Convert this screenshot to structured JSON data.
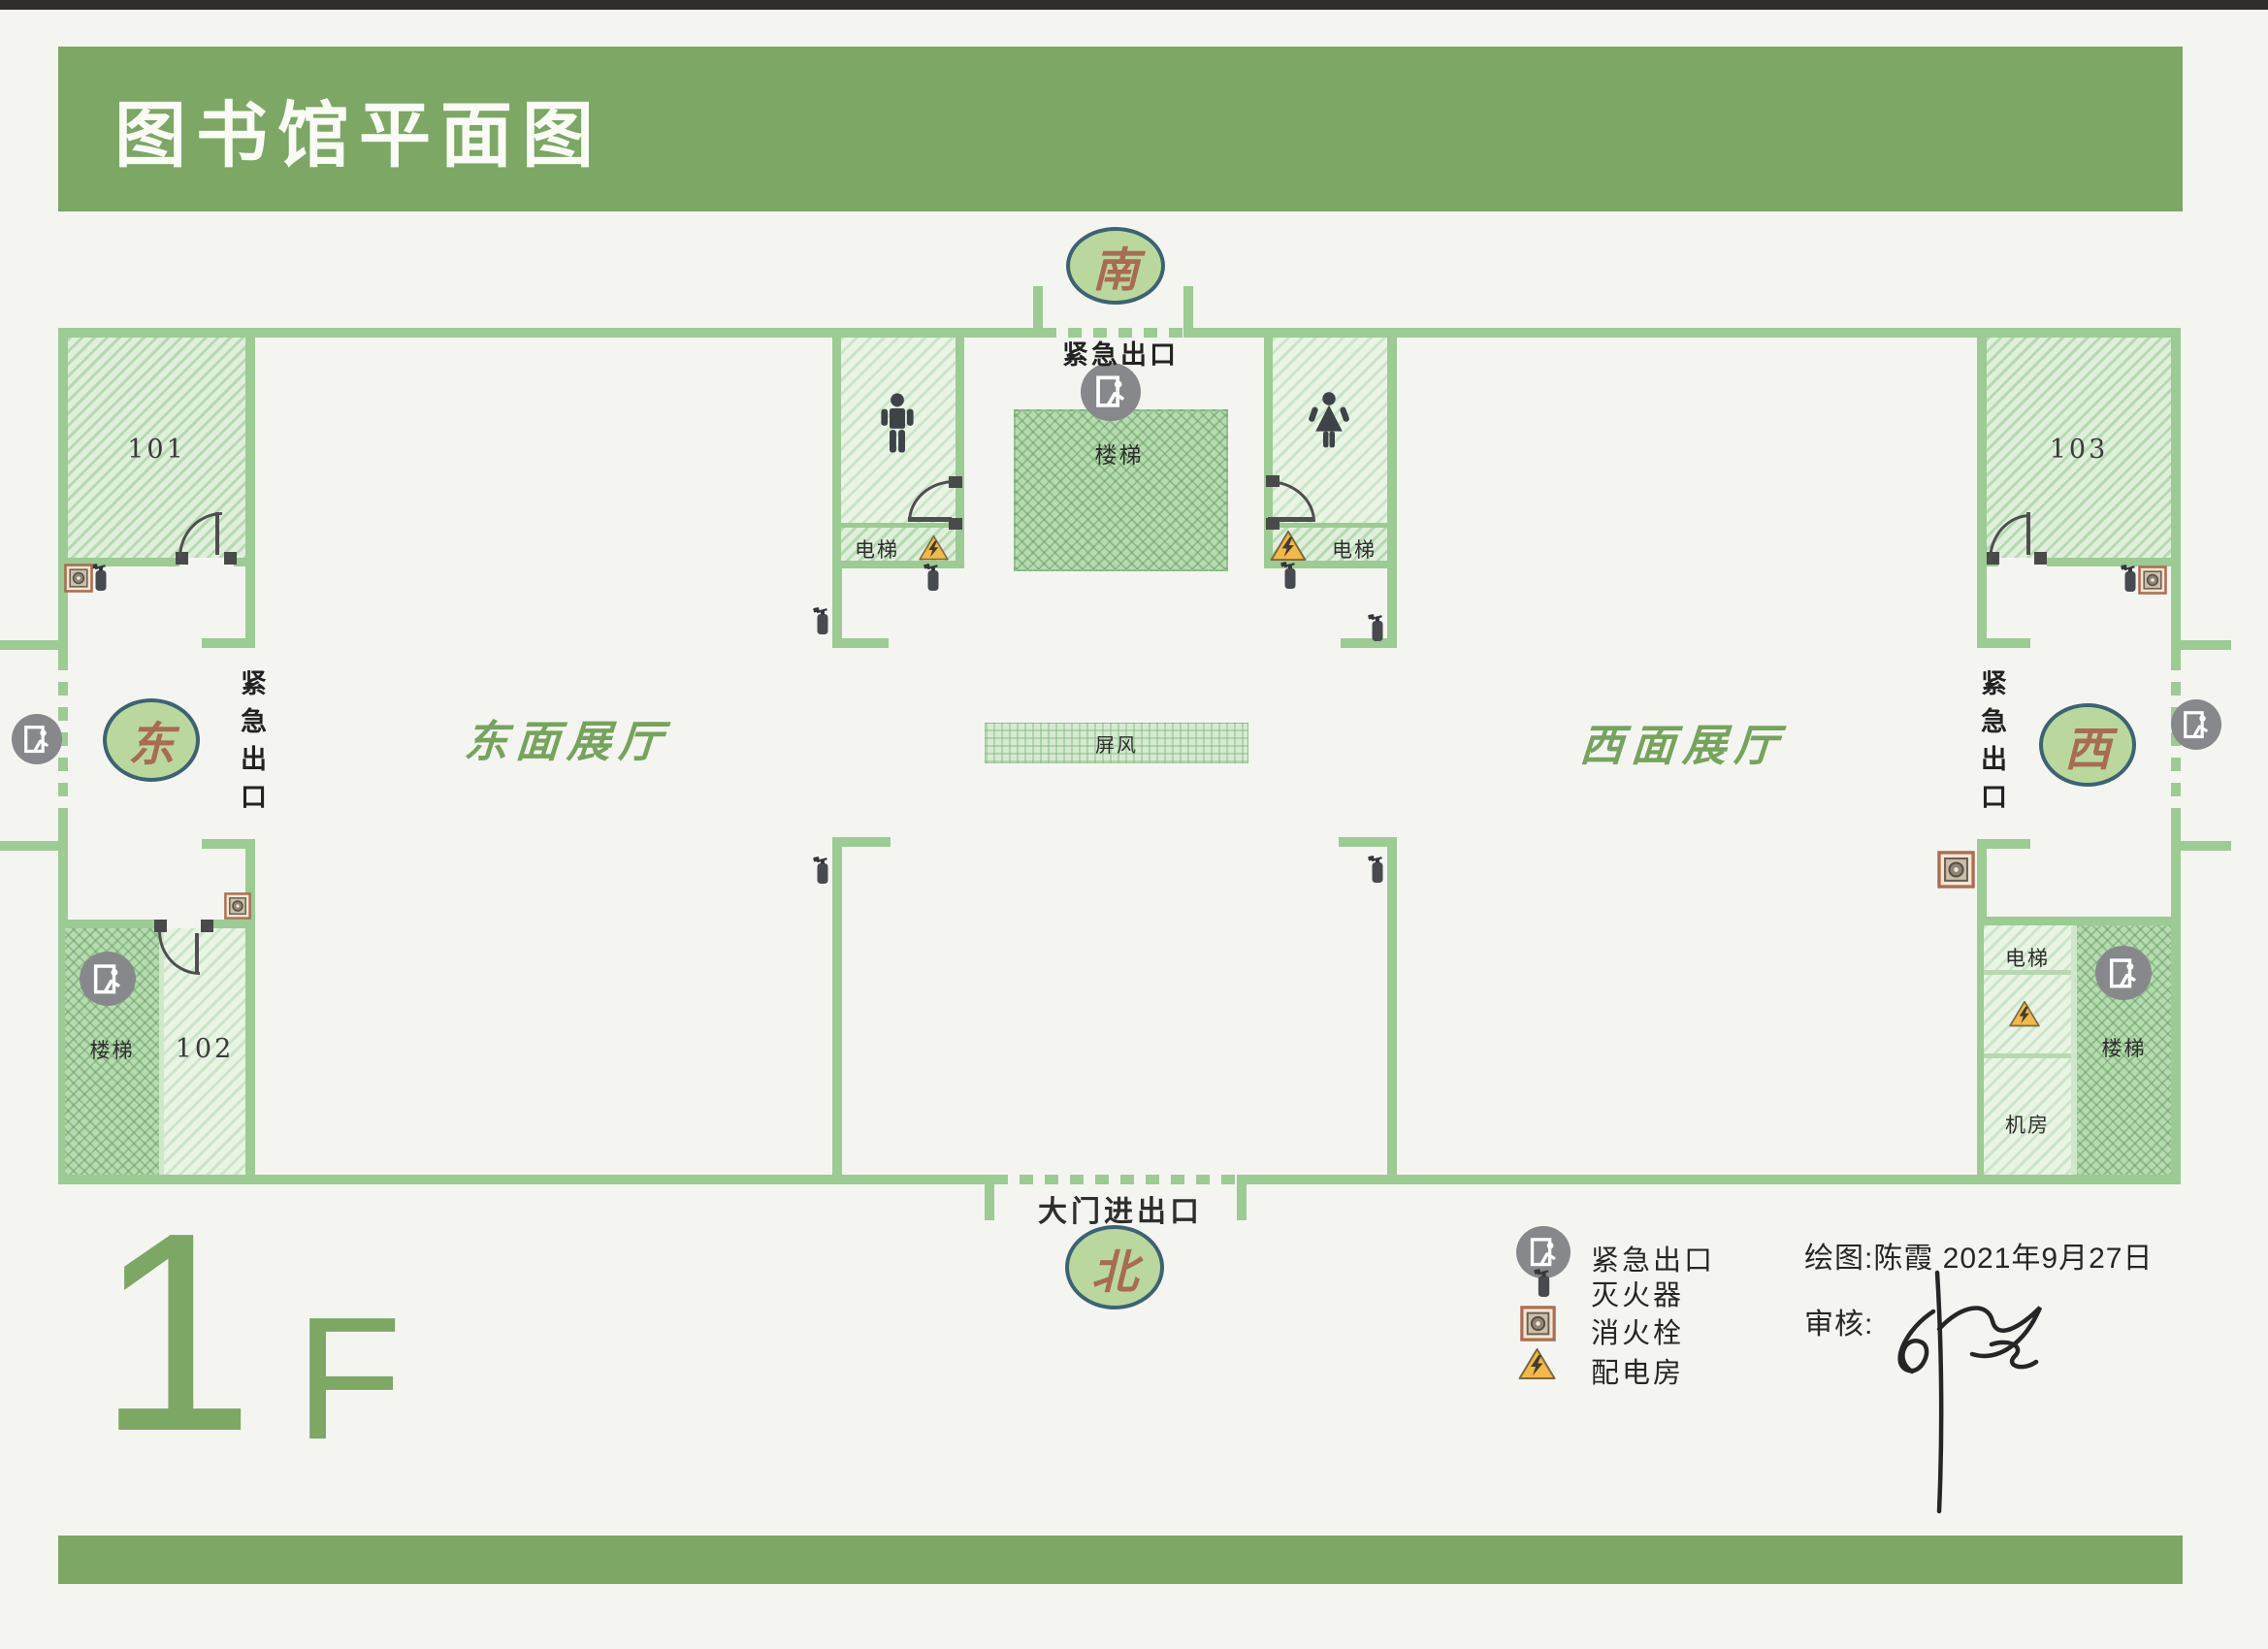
{
  "page": {
    "title": "图书馆平面图",
    "floor_big": "1",
    "floor_small": "F"
  },
  "compass": {
    "south": "南",
    "north": "北",
    "east": "东",
    "west": "西"
  },
  "halls": {
    "east_label": "东面展厅",
    "west_label": "西面展厅"
  },
  "rooms": {
    "room101": "101",
    "room102": "102",
    "room103": "103",
    "stairs_label": "楼梯",
    "elevator_label": "电梯",
    "machine_room_label": "机房",
    "screen_label": "屏风"
  },
  "exits": {
    "emergency_exit_label": "紧急出口",
    "main_entrance_label": "大门进出口"
  },
  "legend": {
    "items": [
      {
        "icon": "emergency-exit-icon",
        "label": "紧急出口"
      },
      {
        "icon": "fire-extinguisher-icon",
        "label": "灭火器"
      },
      {
        "icon": "fire-hydrant-icon",
        "label": "消火栓"
      },
      {
        "icon": "power-room-icon",
        "label": "配电房"
      }
    ]
  },
  "credits": {
    "drawn_by": "绘图:陈霞  2021年9月27日",
    "reviewed_by": "审核:"
  },
  "colors": {
    "banner_green": "#7CA765",
    "wall_green": "#9CCB94",
    "hall_text_green": "#76A35D",
    "compass_fill": "#BAD89E",
    "compass_border": "#3D6373",
    "compass_text": "#A86B54",
    "exit_circle_gray": "#87888C",
    "warning_yellow": "#F2B84A",
    "hydrant_brown": "#AB6E53"
  }
}
